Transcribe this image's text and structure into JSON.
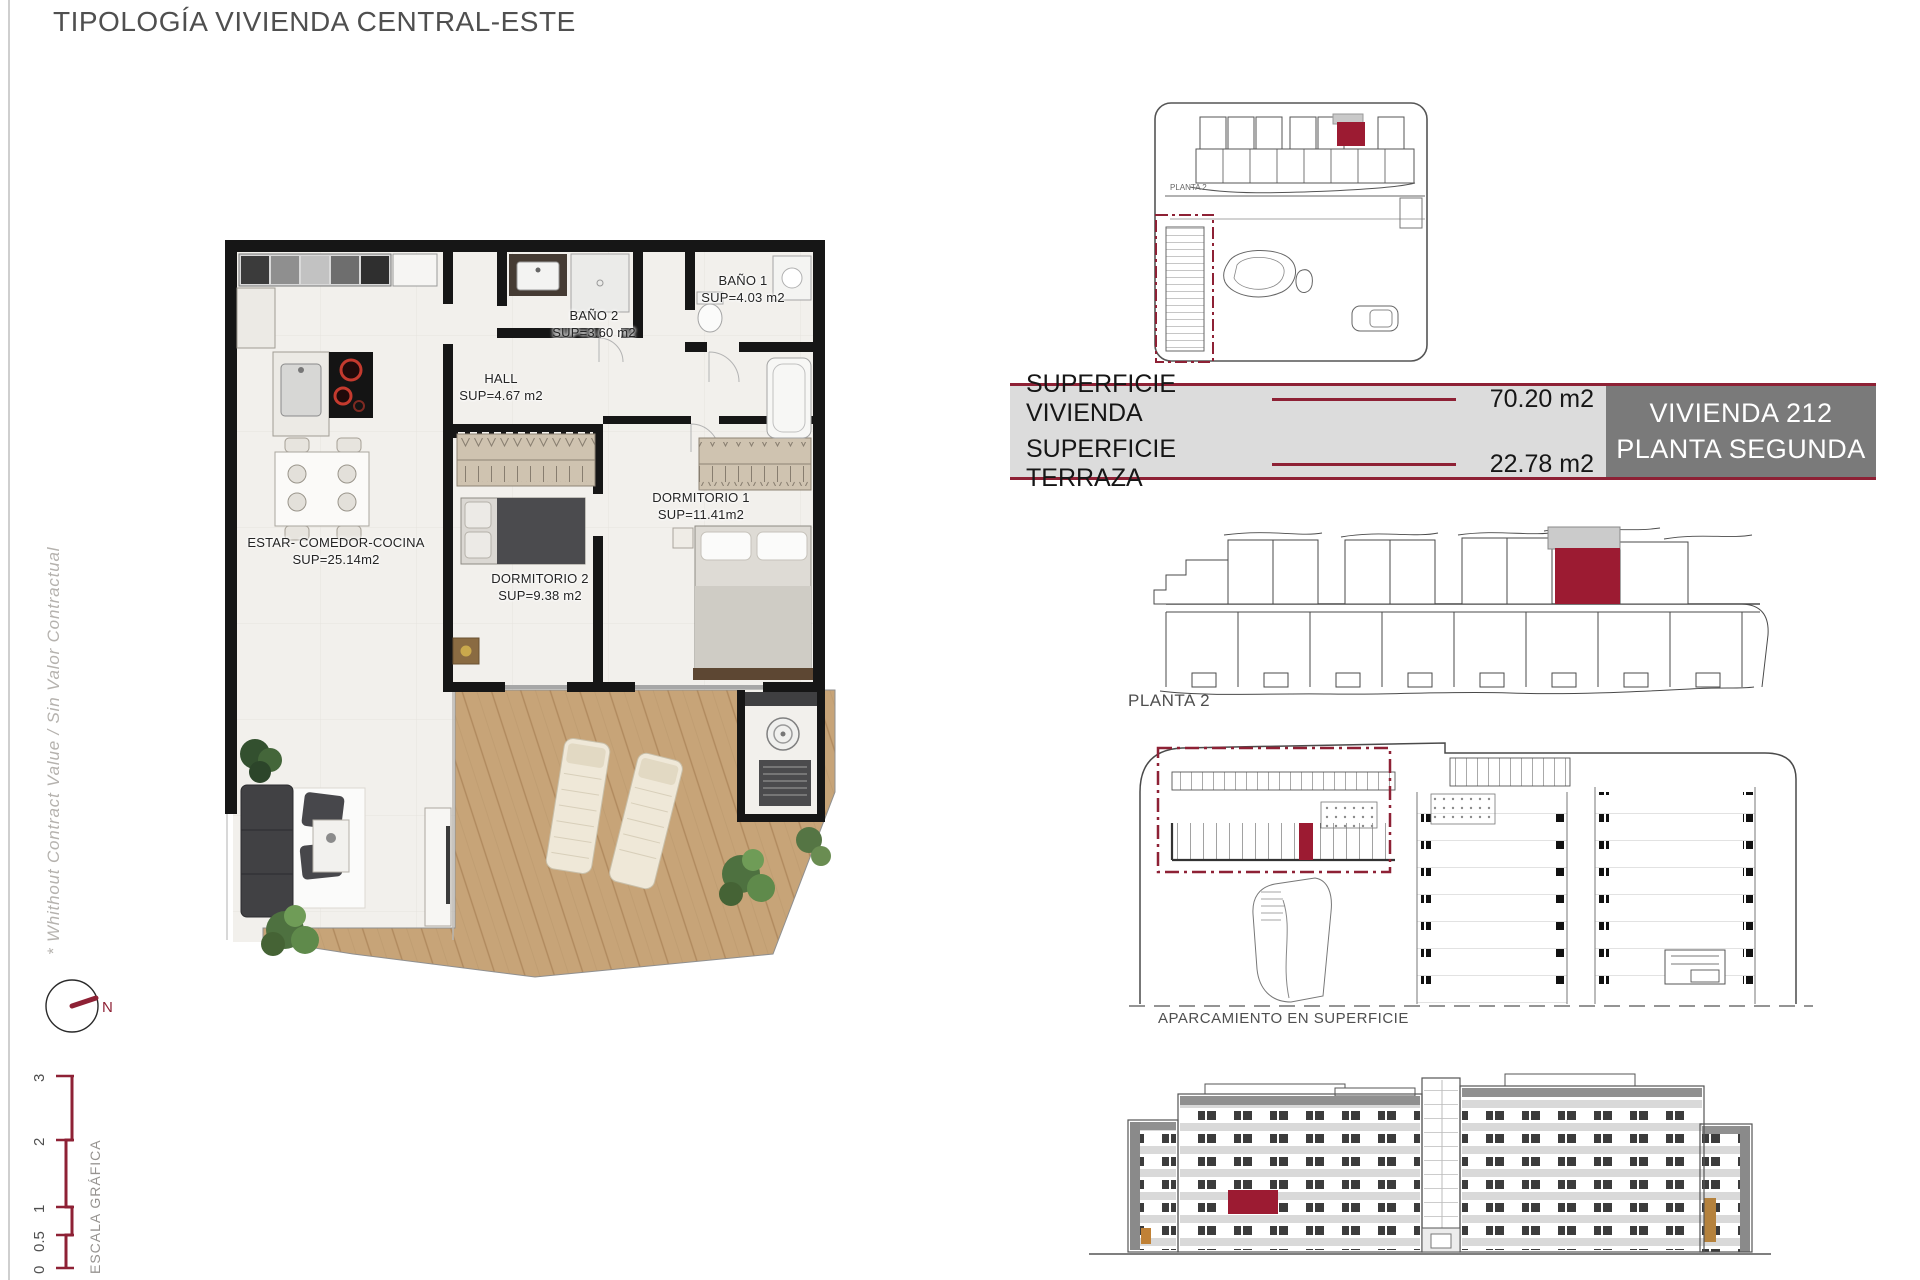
{
  "page": {
    "title": "TIPOLOGÍA VIVIENDA CENTRAL-ESTE",
    "side_note": "* Whithout Contract Value / Sin Valor Contractual",
    "colors": {
      "accent_line": "#8E2135",
      "accent_fill": "#9C1B32",
      "unit_box_gray": "#7A7A7A",
      "bar_background": "#DCDCDC",
      "terrace_wood": "#C7A478",
      "wall_black": "#161616"
    }
  },
  "floor_plan": {
    "rooms": [
      {
        "name": "ESTAR-  COMEDOR-COCINA",
        "area": "SUP=25.14m2"
      },
      {
        "name": "HALL",
        "area": "SUP=4.67  m2"
      },
      {
        "name": "BAÑO  2",
        "area": "SUP=3.60  m2"
      },
      {
        "name": "BAÑO  1",
        "area": "SUP=4.03  m2"
      },
      {
        "name": "DORMITORIO  1",
        "area": "SUP=11.41m2"
      },
      {
        "name": "DORMITORIO  2",
        "area": "SUP=9.38  m2"
      }
    ],
    "compass_label": "N",
    "scale": {
      "title": "ESCALA GRÁFICA",
      "ticks": [
        "0",
        "0.5",
        "1",
        "2",
        "3"
      ]
    }
  },
  "summary": {
    "rows": [
      {
        "label": "SUPERFICIE VIVIENDA",
        "value": "70.20 m2"
      },
      {
        "label": "SUPERFICIE TERRAZA",
        "value": "22.78 m2"
      }
    ],
    "unit": {
      "line1": "VIVIENDA 212",
      "line2": "PLANTA SEGUNDA"
    }
  },
  "drawings": {
    "site_plan_label": "PLANTA 2",
    "floor_label": "PLANTA 2",
    "parking_label": "APARCAMIENTO EN SUPERFICIE"
  }
}
